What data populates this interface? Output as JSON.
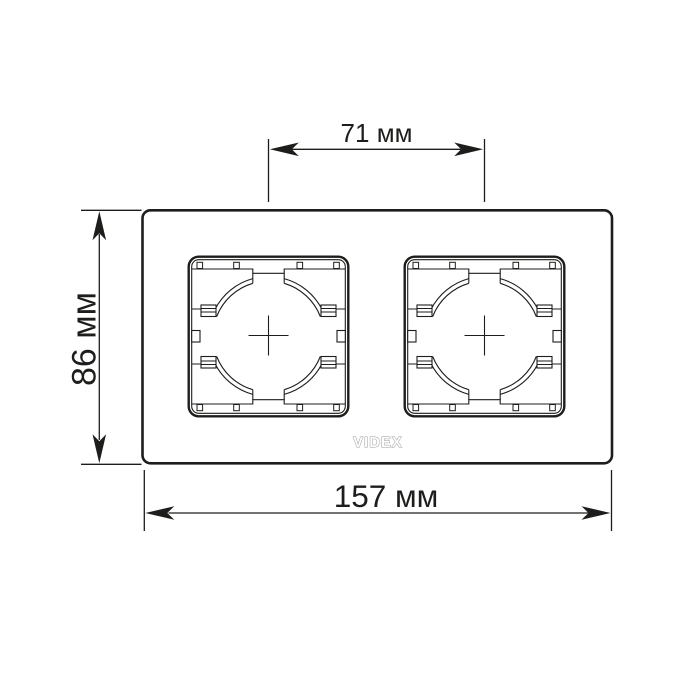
{
  "colors": {
    "background": "#ffffff",
    "line": "#1d1d1b",
    "logo": "#9b9b9b",
    "text": "#1d1d1b"
  },
  "labels": {
    "socket_spacing": "71 мм",
    "frame_height": "86 мм",
    "frame_width": "157 мм",
    "brand": "VIDEX"
  },
  "values": {
    "socket_spacing_mm": 71,
    "frame_height_mm": 86,
    "frame_width_mm": 157,
    "unit": "мм",
    "socket_count": 2
  }
}
